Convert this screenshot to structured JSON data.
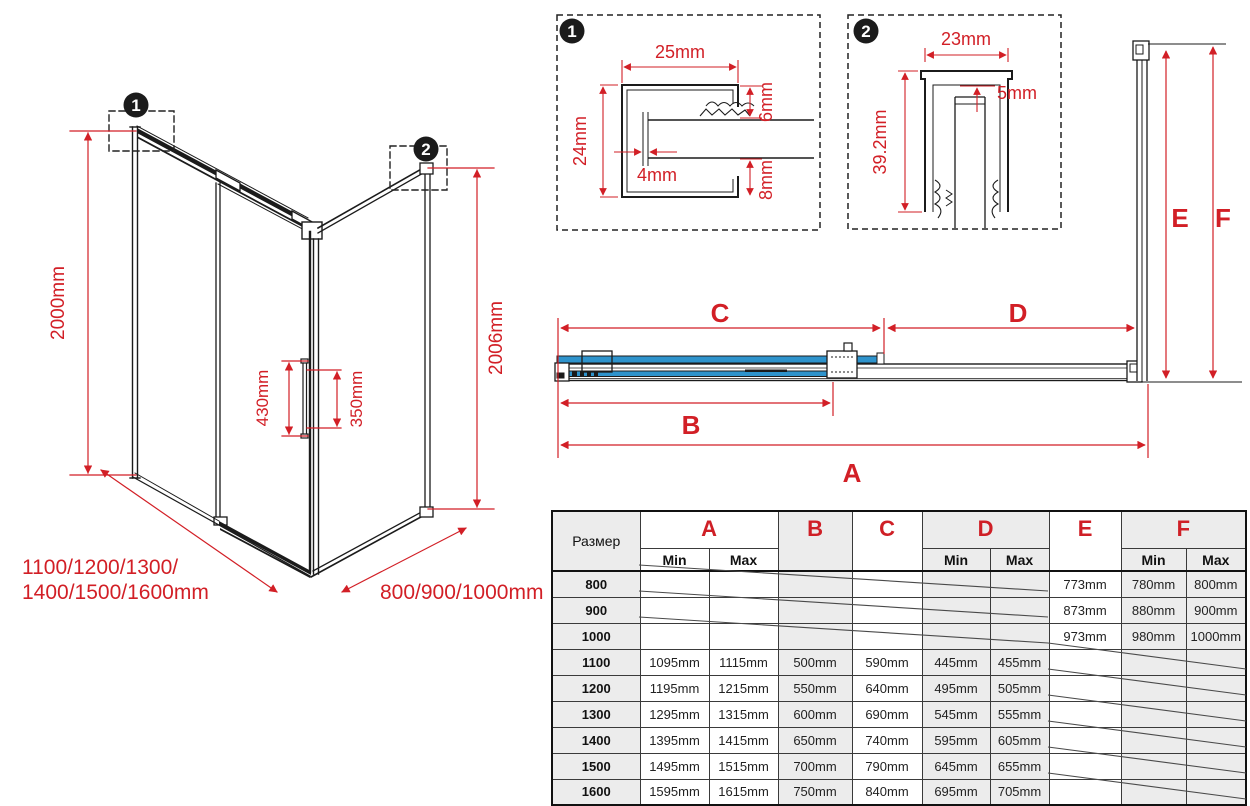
{
  "colors": {
    "red": "#d21f26",
    "blue": "#2e93cc",
    "line": "#1b1b1b",
    "cell_gray": "#ececec"
  },
  "iso_view": {
    "callout_1": "1",
    "callout_2": "2",
    "height_left": "2000mm",
    "height_right": "2006mm",
    "handle_height": "430mm",
    "handle_inner": "350mm",
    "width_sizes_line1": "1100/1200/1300/",
    "width_sizes_line2": "1400/1500/1600mm",
    "depth_sizes": "800/900/1000mm"
  },
  "detail_1": {
    "number": "1",
    "dim_width": "25mm",
    "dim_height": "24mm",
    "dim_wall": "4mm",
    "dim_gap_top": "6mm",
    "dim_gap_bottom": "8mm"
  },
  "detail_2": {
    "number": "2",
    "dim_width": "23mm",
    "dim_height": "39.2mm",
    "dim_gap": "5mm"
  },
  "plan_view": {
    "dim_a": "A",
    "dim_b": "B",
    "dim_c": "C",
    "dim_d": "D",
    "dim_e": "E",
    "dim_f": "F"
  },
  "table": {
    "size_label": "Размер",
    "letters": [
      "A",
      "B",
      "C",
      "D",
      "E",
      "F"
    ],
    "min_label": "Min",
    "max_label": "Max",
    "rows": [
      [
        "800",
        "",
        "",
        "",
        "",
        "",
        "",
        "773mm",
        "780mm",
        "800mm"
      ],
      [
        "900",
        "",
        "",
        "",
        "",
        "",
        "",
        "873mm",
        "880mm",
        "900mm"
      ],
      [
        "1000",
        "",
        "",
        "",
        "",
        "",
        "",
        "973mm",
        "980mm",
        "1000mm"
      ],
      [
        "1100",
        "1095mm",
        "1115mm",
        "500mm",
        "590mm",
        "445mm",
        "455mm",
        "",
        "",
        ""
      ],
      [
        "1200",
        "1195mm",
        "1215mm",
        "550mm",
        "640mm",
        "495mm",
        "505mm",
        "",
        "",
        ""
      ],
      [
        "1300",
        "1295mm",
        "1315mm",
        "600mm",
        "690mm",
        "545mm",
        "555mm",
        "",
        "",
        ""
      ],
      [
        "1400",
        "1395mm",
        "1415mm",
        "650mm",
        "740mm",
        "595mm",
        "605mm",
        "",
        "",
        ""
      ],
      [
        "1500",
        "1495mm",
        "1515mm",
        "700mm",
        "790mm",
        "645mm",
        "655mm",
        "",
        "",
        ""
      ],
      [
        "1600",
        "1595mm",
        "1615mm",
        "750mm",
        "840mm",
        "695mm",
        "705mm",
        "",
        "",
        ""
      ]
    ]
  }
}
